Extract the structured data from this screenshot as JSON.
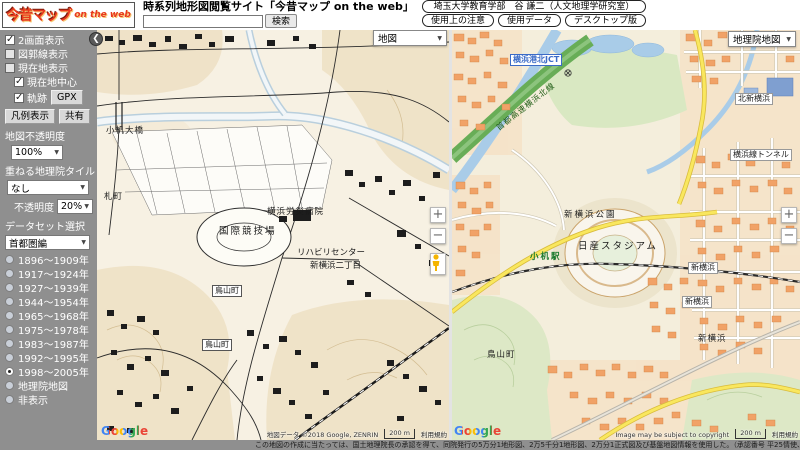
{
  "header": {
    "logo": {
      "main": "今昔マップ",
      "sub": "on the web"
    },
    "site_title": "時系列地形図閲覧サイト「今昔マップ on the web」",
    "search": {
      "value": "",
      "button_label": "検索"
    },
    "links": {
      "credit": "埼玉大学教育学部　谷 謙二（人文地理学研究室）",
      "notes": "使用上の注意",
      "data": "使用データ",
      "desktop": "デスクトップ版"
    }
  },
  "sidebar": {
    "collapse_icon": "❮",
    "checkboxes": [
      {
        "label": "2画面表示",
        "checked": true
      },
      {
        "label": "図郭線表示",
        "checked": false
      },
      {
        "label": "現在地表示",
        "checked": false
      },
      {
        "label": "現在地中心",
        "checked": true
      },
      {
        "label": "軌跡",
        "checked": true
      }
    ],
    "gpx_button": "GPX",
    "legend_button": "凡例表示",
    "share_button": "共有",
    "map_opacity_label": "地図不透明度",
    "map_opacity_value": "100%",
    "overlay_tile_label": "重ねる地理院タイル",
    "overlay_tile_value": "なし",
    "overlay_opacity_label": "不透明度",
    "overlay_opacity_value": "20%",
    "dataset_label": "データセット選択",
    "dataset_value": "首都圏編",
    "periods": [
      {
        "label": "1896～1909年",
        "selected": false
      },
      {
        "label": "1917～1924年",
        "selected": false
      },
      {
        "label": "1927～1939年",
        "selected": false
      },
      {
        "label": "1944～1954年",
        "selected": false
      },
      {
        "label": "1965～1968年",
        "selected": false
      },
      {
        "label": "1975～1978年",
        "selected": false
      },
      {
        "label": "1983～1987年",
        "selected": false
      },
      {
        "label": "1992～1995年",
        "selected": false
      },
      {
        "label": "1998～2005年",
        "selected": true
      },
      {
        "label": "地理院地図",
        "selected": false
      },
      {
        "label": "非表示",
        "selected": false
      }
    ]
  },
  "left_map": {
    "layer_select_value": "地図",
    "zoom_in": "+",
    "zoom_out": "−",
    "labels": [
      {
        "text": "小机大橋"
      },
      {
        "text": "札町"
      },
      {
        "text": "横浜労災病院"
      },
      {
        "text": "国際競技場"
      },
      {
        "text": "リハビリセンター"
      },
      {
        "text": "新横浜二丁目"
      },
      {
        "text": "鳥山町"
      },
      {
        "text": "鳥山町"
      }
    ],
    "google_logo": "Google",
    "attribution": "地図データ ©2018 Google, ZENRIN",
    "scale_label": "200 m",
    "terms_link": "利用規約"
  },
  "right_map": {
    "layer_select_value": "地理院地図",
    "zoom_in": "+",
    "zoom_out": "−",
    "labels": [
      {
        "text": "横浜港北JCT"
      },
      {
        "text": "首都高速横浜北線"
      },
      {
        "text": "北新横浜"
      },
      {
        "text": "横浜線トンネル"
      },
      {
        "text": "新横浜公園"
      },
      {
        "text": "日産スタジアム"
      },
      {
        "text": "小机駅"
      },
      {
        "text": "新横浜"
      },
      {
        "text": "新横浜"
      },
      {
        "text": "新横浜"
      },
      {
        "text": "鳥山町"
      }
    ],
    "google_logo": "Google",
    "attribution": "Image may be subject to copyright",
    "scale_label": "200 m",
    "terms_link": "利用規約"
  },
  "footer": {
    "text": "この地図の作成に当たっては、国土地理院長の承認を得て、同院発行の5万分1地形図、2万5千分1地形図、2万分1正式図及び基盤地図情報を使用した。（承認番号 平25情使、第365号）この地図は、国土地理院長の承認を得て、同院発行の5万分1地形図、2万5千分1地形図、2万分1正式図を複製したものである。"
  },
  "colors": {
    "sidebar_bg": "#8f8f8f",
    "logo_red": "#e8381d",
    "old_map_tint": "#e9d7b2",
    "gsi_building_orange": "#f1a267",
    "gsi_road_yellow": "#f9e75e",
    "gsi_highway_green": "#68ad57",
    "gsi_water_blue": "#a9cce8"
  }
}
